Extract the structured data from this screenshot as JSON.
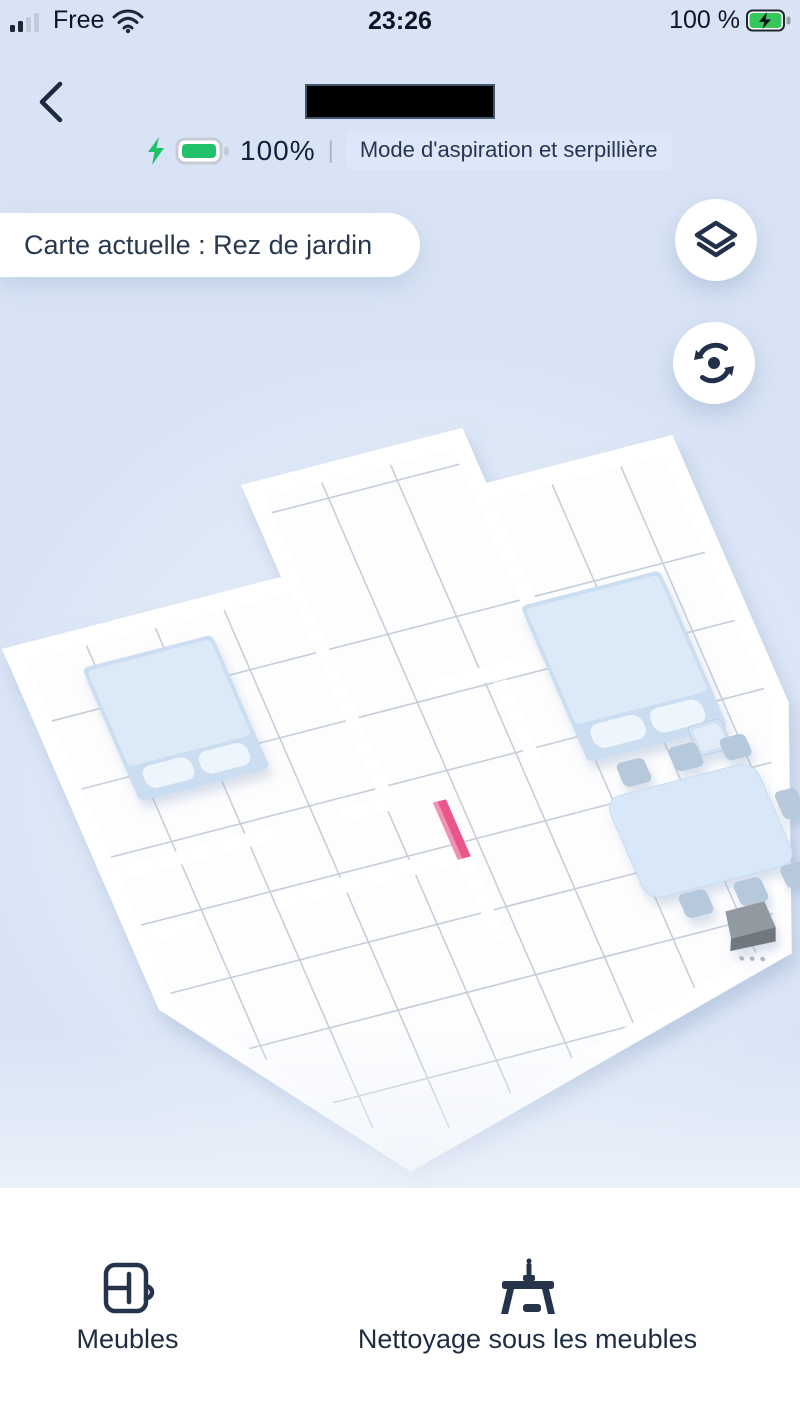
{
  "status_bar": {
    "carrier": "Free",
    "time": "23:26",
    "battery_percent": "100 %",
    "icons": [
      "signal-bars-icon",
      "wifi-icon",
      "battery-charging-icon"
    ]
  },
  "header": {
    "back_icon": "back-chevron-icon",
    "redacted_title": "",
    "robot_battery_level": "100%",
    "divider": "|",
    "mode_badge": "Mode d'aspiration et serpillière",
    "battery_icon": "battery-full-charging-icon",
    "bolt_icon": "charging-bolt-icon"
  },
  "map": {
    "current_map_label": "Carte actuelle : Rez de jardin",
    "layers_button_icon": "layers-icon",
    "rotate_button_icon": "rotate-reset-icon",
    "objects": [
      "bed",
      "bed",
      "nightstand",
      "dining-table",
      "chairs",
      "charging-dock",
      "pink-door-marker"
    ]
  },
  "bottom_nav": {
    "items": [
      {
        "label": "Meubles",
        "icon": "furniture-icon"
      },
      {
        "label": "Nettoyage sous les meubles",
        "icon": "clean-under-furniture-icon"
      }
    ]
  },
  "colors": {
    "background": "#D8E4F5",
    "navy_text": "#1D2C42",
    "battery_green": "#21C06A",
    "bed_blue": "#D8E8F8",
    "marker_pink": "#E8578B",
    "badge_background": "#DEE6F9",
    "wall_white": "#FFFFFF",
    "grid_line": "#C4CDDA",
    "dock_gray": "#9199A1"
  }
}
